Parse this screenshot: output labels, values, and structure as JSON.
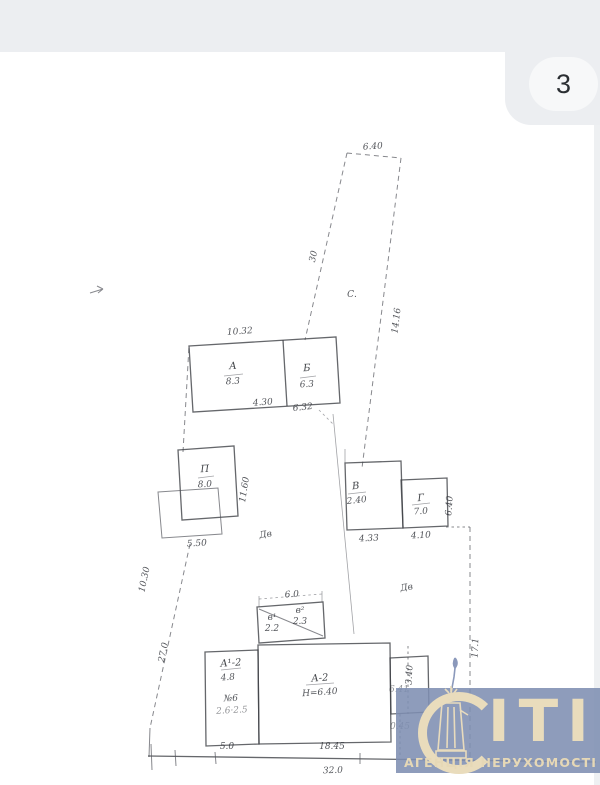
{
  "viewer": {
    "counter": "3"
  },
  "watermark": {
    "brand": "СІТІ",
    "brand_rest": "ІТІ",
    "tagline": "АГЕНЦІЯ НЕРУХОМОСТІ"
  },
  "colors": {
    "watermark_bg": "#7e8eb2",
    "watermark_fg": "#e9dcbc",
    "band_bg": "#eceef1",
    "pill_bg": "#f7f8f9",
    "ink": "#54565c"
  },
  "plan": {
    "labels": {
      "top_width": "6.40",
      "wedge_left_len": "30",
      "wedge_right_len": "14.16",
      "garden_mark": "С.",
      "block_top_dim": "10.32",
      "bldA_letter": "А",
      "bldA_value": "8.3",
      "bldB_letter": "Б",
      "bldB_value": "6.3",
      "bldA_bottom_dim": "4.30",
      "bldB_bottom_dim": "6.32",
      "bldP_letter": "П",
      "bldP_value": "8.0",
      "bldP_side_dim": "11.60",
      "bldP_bottom_dim": "5.50",
      "bldV_letter": "В",
      "bldV_value": "2.40",
      "bldV_bottom_dim": "4.33",
      "bldG_letter": "Г",
      "bldG_value": "7.0",
      "bldG_bottom_dim": "4.10",
      "bldG_side_dim": "6.40",
      "yard_mark_1": "Дв",
      "yard_mark_2": "Дв",
      "shed_top_dim": "6.0",
      "shed_left_letter": "в¹",
      "shed_left_value": "2.2",
      "shed_right_letter": "в²",
      "shed_right_value": "2.3",
      "annex_line1": "А¹-2",
      "annex_line2": "4.8",
      "annex_line3": "№6",
      "annex_line4": "2.6·2.5",
      "annex_bottom_dim": "5.0",
      "house_letter": "А-2",
      "house_height": "Н=6.40",
      "house_bottom_dim": "18.45",
      "small_box_dim": "3.40",
      "small_box_value": "6.41",
      "small_box_value2": "0.45",
      "left_bound_dim1": "10.30",
      "left_bound_dim2": "27.0",
      "right_bound_dim": "17.1",
      "bottom_total_dim": "32.0"
    }
  }
}
